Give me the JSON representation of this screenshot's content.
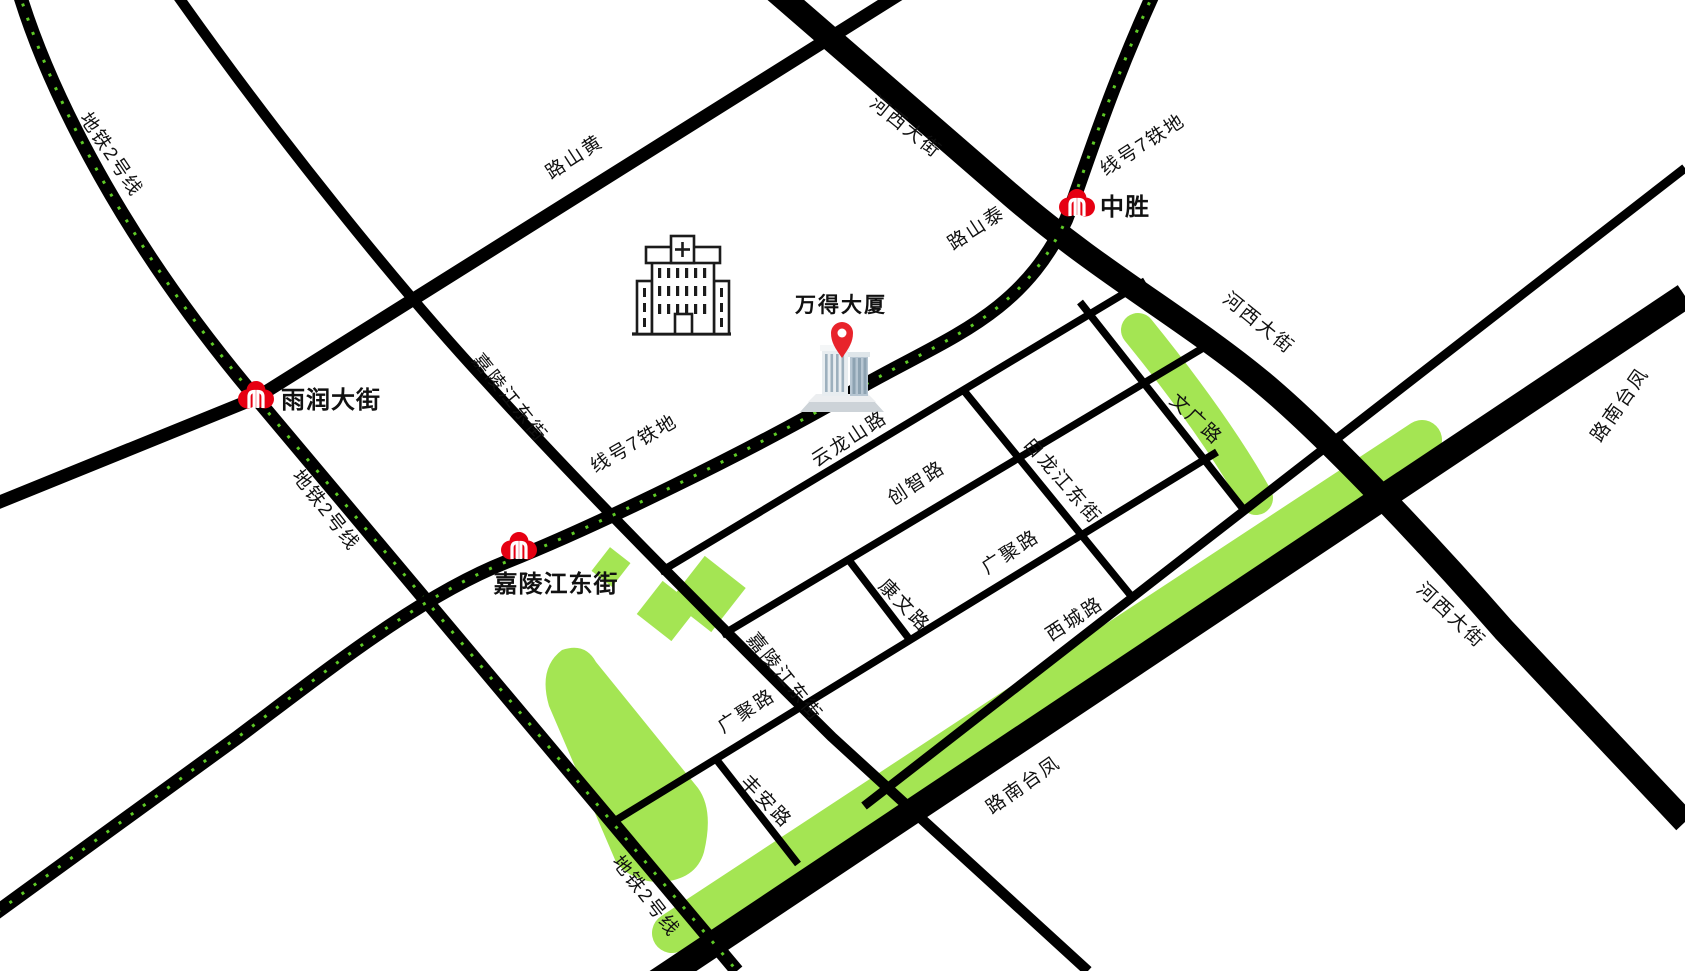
{
  "palette": {
    "road": "#000000",
    "metro_dot": "#5ec926",
    "park_green": "#a4e553",
    "station_red": "#e60012",
    "landmark_red": "#e8232b",
    "label_color": "#111111"
  },
  "landmark": {
    "name": "万得大厦"
  },
  "stations": [
    {
      "name": "中胜"
    },
    {
      "name": "雨润大街"
    },
    {
      "name": "嘉陵江东街"
    }
  ],
  "metro_lines": [
    {
      "name": "地铁2号线"
    },
    {
      "name": "地铁7号线"
    }
  ],
  "roads": [
    {
      "name": "河西大街"
    },
    {
      "name": "凤台南路"
    },
    {
      "name": "黄山路"
    },
    {
      "name": "泰山路"
    },
    {
      "name": "嘉陵江东街"
    },
    {
      "name": "云龙山路"
    },
    {
      "name": "创智路"
    },
    {
      "name": "白龙江东街"
    },
    {
      "name": "文广路"
    },
    {
      "name": "广聚路"
    },
    {
      "name": "康文路"
    },
    {
      "name": "西城路"
    },
    {
      "name": "丰安路"
    }
  ],
  "labels": {
    "road": [
      {
        "text": "黄山路"
      },
      {
        "text": "泰山路"
      },
      {
        "text": "河西大街"
      },
      {
        "text": "河西大街"
      },
      {
        "text": "河西大街"
      },
      {
        "text": "凤台南路"
      },
      {
        "text": "凤台南路"
      },
      {
        "text": "嘉陵江东街"
      },
      {
        "text": "嘉陵江东街"
      },
      {
        "text": "云龙山路"
      },
      {
        "text": "创智路"
      },
      {
        "text": "白龙江东街"
      },
      {
        "text": "文广路"
      },
      {
        "text": "广聚路"
      },
      {
        "text": "广聚路"
      },
      {
        "text": "康文路"
      },
      {
        "text": "西城路"
      },
      {
        "text": "丰安路"
      }
    ],
    "metro": [
      {
        "text": "地铁2号线"
      },
      {
        "text": "地铁2号线"
      },
      {
        "text": "地铁2号线"
      },
      {
        "text": "地铁7号线"
      },
      {
        "text": "地铁7号线"
      }
    ]
  },
  "poi": {
    "hospital": "hospital"
  }
}
